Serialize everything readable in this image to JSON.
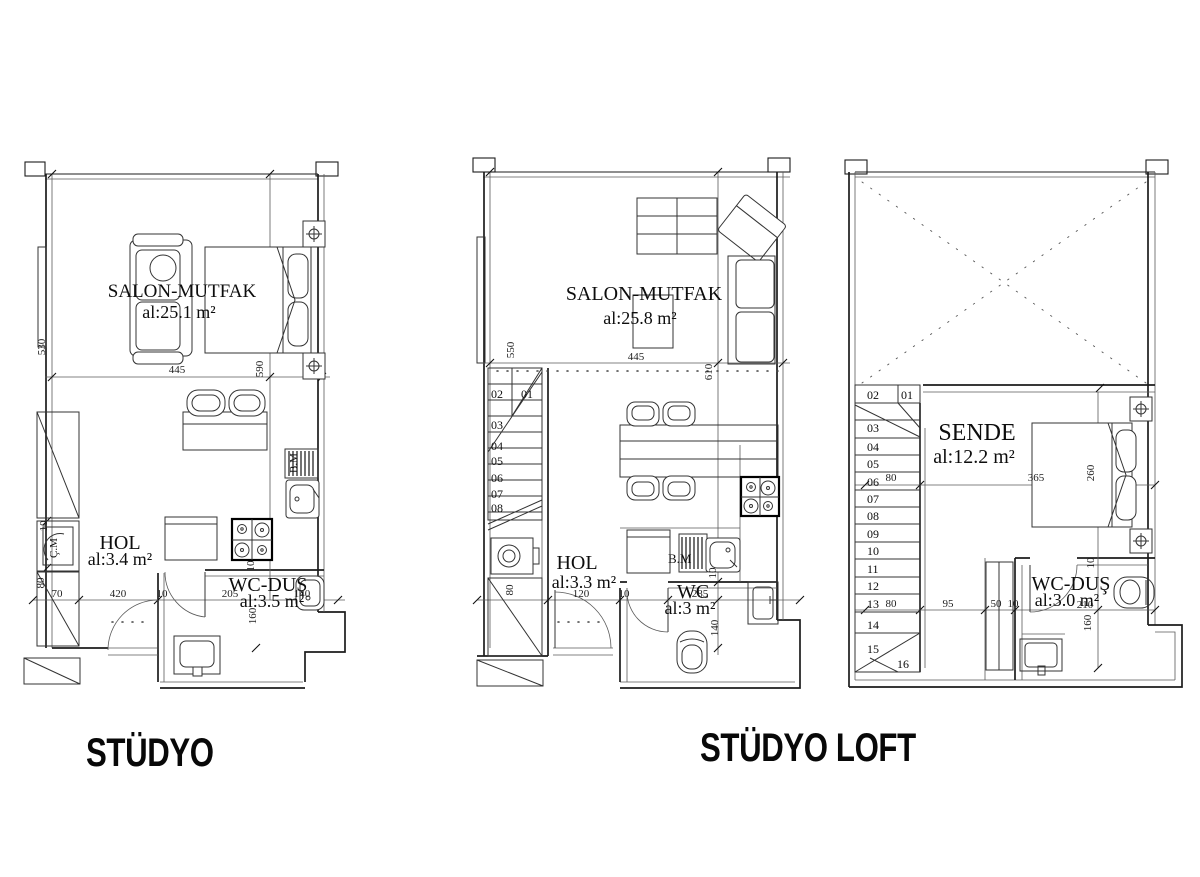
{
  "titles": {
    "studyo": "STÜDYO",
    "studyo_loft": "STÜDYO LOFT"
  },
  "p1": {
    "salon_name": "SALON-MUTFAK",
    "salon_area": "al:25.1 m²",
    "hol_name": "HOL",
    "hol_area": "al:3.4 m²",
    "wc_name": "WC-DUŞ",
    "wc_area": "al:3.5 m²",
    "washing_machine": "Ç.M",
    "dishwasher": "B.M",
    "dims": {
      "v530": "530",
      "h445": "445",
      "v590": "590",
      "v10a": "10",
      "v80": "80",
      "h70": "70",
      "h420": "420",
      "h10": "10",
      "h205": "205",
      "h140": "140",
      "v160": "160",
      "v10b": "10"
    }
  },
  "p2": {
    "salon_name": "SALON-MUTFAK",
    "salon_area": "al:25.8 m²",
    "hol_name": "HOL",
    "hol_area": "al:3.3 m²",
    "wc_name": "WC",
    "wc_area": "al:3 m²",
    "dishwasher": "B.M",
    "stairs": [
      "01",
      "02",
      "03",
      "04",
      "05",
      "06",
      "07",
      "08"
    ],
    "dims": {
      "v550": "550",
      "h445": "445",
      "v610": "610",
      "v80": "80",
      "h120": "120",
      "h10": "10",
      "h285": "285",
      "v10": "10",
      "v140": "140"
    }
  },
  "p3": {
    "room_name": "SENDE",
    "room_area": "al:12.2 m²",
    "wc_name": "WC-DUŞ",
    "wc_area": "al:3.0 m²",
    "stairs": [
      "01",
      "02",
      "03",
      "04",
      "05",
      "06",
      "07",
      "08",
      "09",
      "10",
      "11",
      "12",
      "13",
      "14",
      "15",
      "16"
    ],
    "dims": {
      "h80a": "80",
      "h365": "365",
      "v260": "260",
      "h80b": "80",
      "h95": "95",
      "h50": "50",
      "h10a": "10",
      "h210": "210",
      "v160": "160",
      "v10b": "10"
    }
  }
}
